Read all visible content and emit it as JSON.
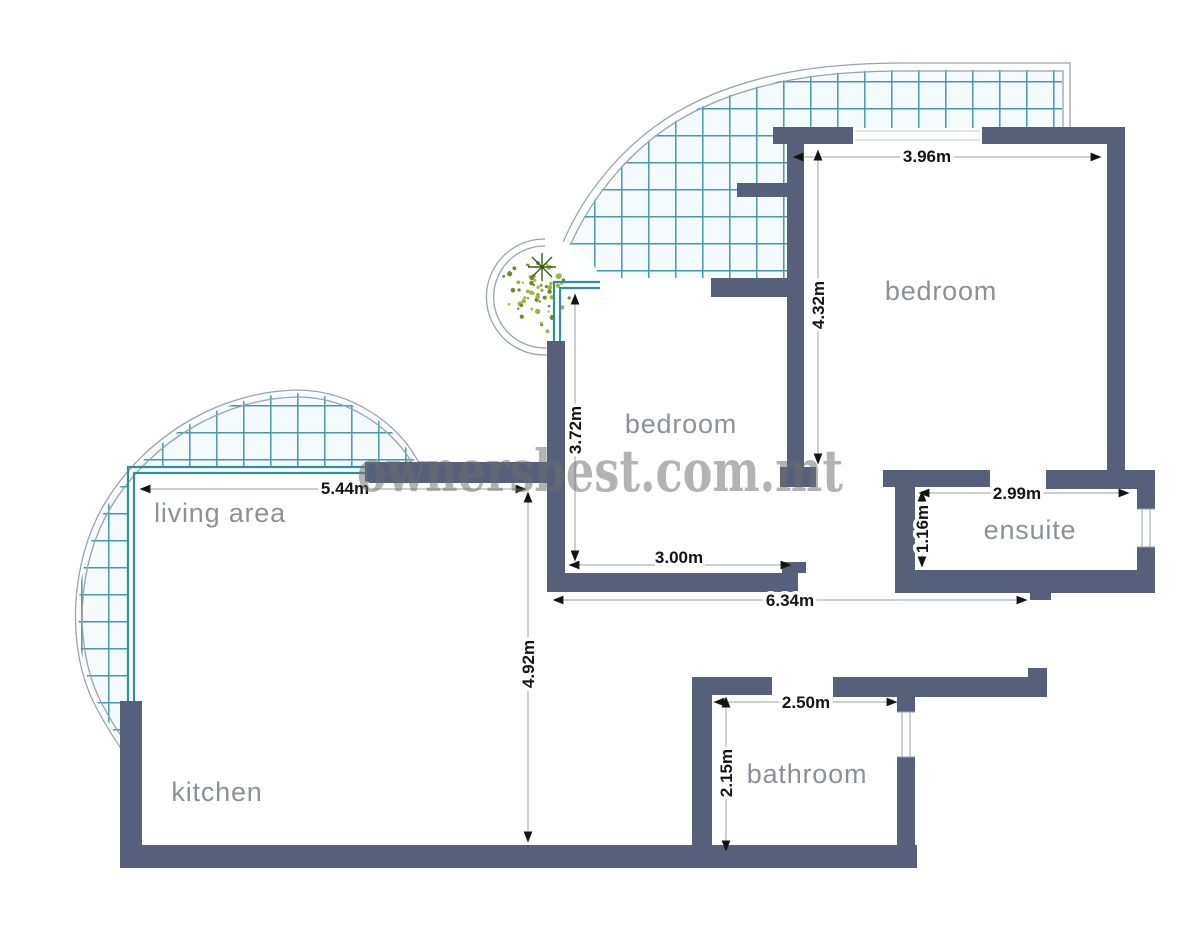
{
  "watermark": "ownersbest.com.mt",
  "rooms": {
    "bedroom_main": "bedroom",
    "bedroom_second": "bedroom",
    "ensuite": "ensuite",
    "bathroom": "bathroom",
    "living_area": "living area",
    "kitchen": "kitchen"
  },
  "dimensions": {
    "bedroom_main_width": "3.96m",
    "bedroom_main_depth": "4.32m",
    "bedroom_second_depth": "3.72m",
    "bedroom_second_width": "3.00m",
    "living_area_width": "5.44m",
    "living_area_depth": "4.92m",
    "hall_length": "6.34m",
    "ensuite_width": "2.99m",
    "ensuite_depth": "1.16m",
    "bathroom_width": "2.50m",
    "bathroom_depth": "2.15m"
  },
  "colors": {
    "wall": "#56607a",
    "tile_line": "#4499ad",
    "window": "#2d8fa4",
    "room_label": "#8b919c",
    "dimension_text": "#141414",
    "watermark": "#6e6e6e",
    "plant": "#7fa32c"
  }
}
